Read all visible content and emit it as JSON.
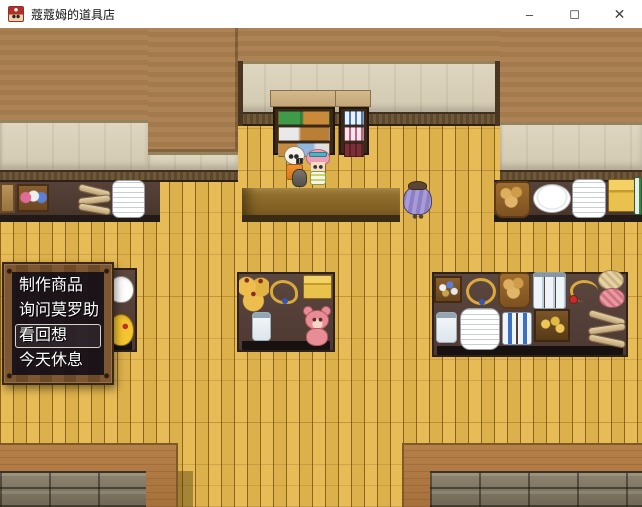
{
  "window": {
    "title": "蔻蔻姆的道具店",
    "app_icon": "game-mascot-icon",
    "controls": {
      "minimize_glyph": "–",
      "maximize_glyph": "◻",
      "close_glyph": "✕"
    }
  },
  "menu": {
    "items": [
      {
        "label": "制作商品",
        "selected": false
      },
      {
        "label": "询问莫罗助",
        "selected": false
      },
      {
        "label": "看回想",
        "selected": true
      },
      {
        "label": "今天休息",
        "selected": false
      }
    ]
  },
  "scene": {
    "npcs": [
      "shopkeeper",
      "pink-haired-customer",
      "purple-ghost"
    ],
    "colors": {
      "floor_yellow": "#e2b54d",
      "wall_brown": "#a87e52",
      "wall_beige": "#d8d0ba",
      "counter_dark": "#4a382f",
      "menu_frame_wood": "#7a5531",
      "menu_backdrop": "rgba(22,15,24,0.92)",
      "selection_border": "rgba(255,255,240,0.8)"
    }
  }
}
